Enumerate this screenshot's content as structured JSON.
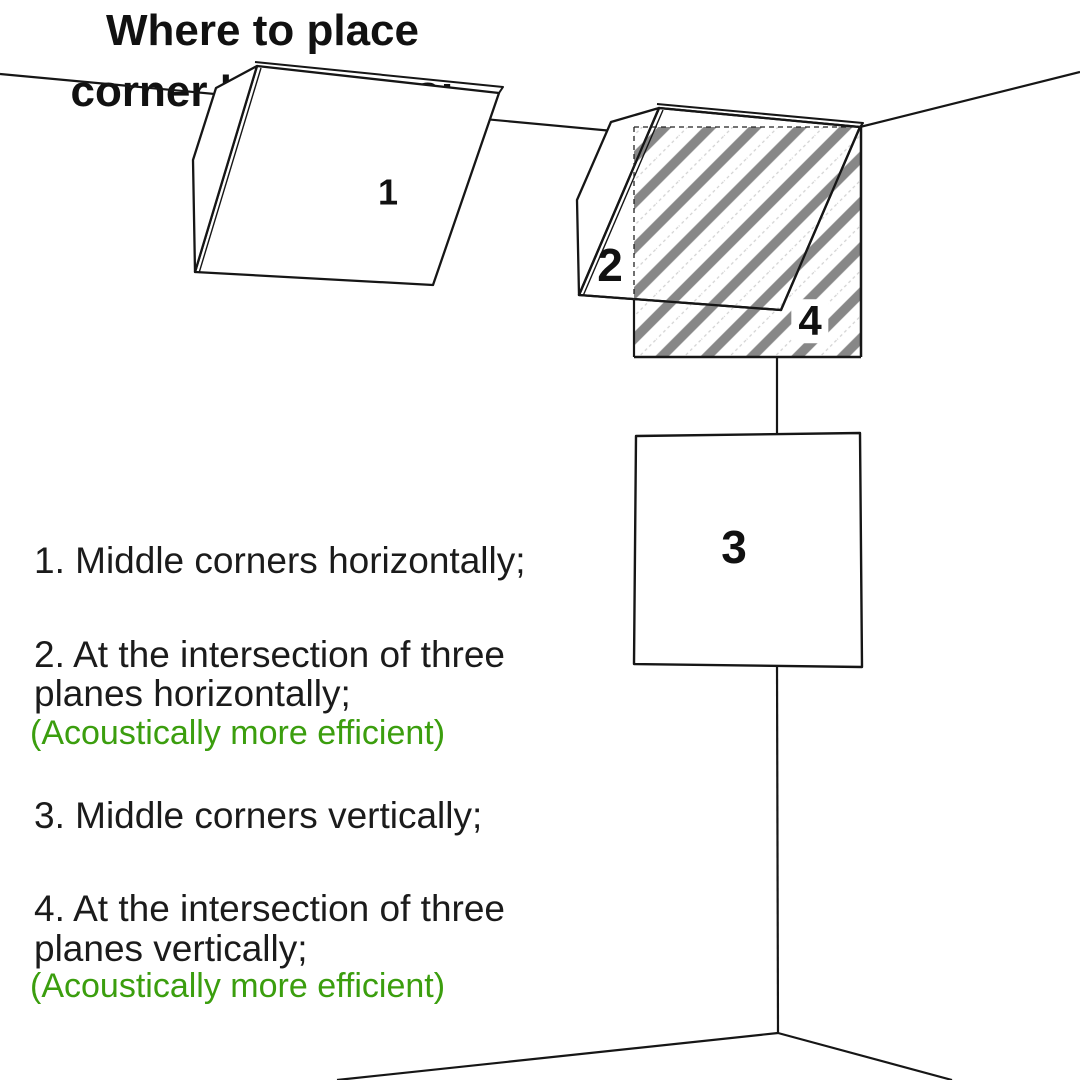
{
  "title": {
    "line1": "Where to place",
    "line2": "corner bass traps:"
  },
  "list": {
    "item1": {
      "line1": "1. Middle corners horizontally;"
    },
    "item2": {
      "line1": "2. At the intersection of three",
      "line2": "planes horizontally;",
      "note": "(Acoustically more efficient)"
    },
    "item3": {
      "line1": "3. Middle corners vertically;"
    },
    "item4": {
      "line1": "4. At the intersection of three",
      "line2": "planes vertically;",
      "note": "(Acoustically more efficient)"
    }
  },
  "diagram": {
    "labels": {
      "trap1": "1",
      "trap2": "2",
      "trap3": "3",
      "trap4": "4"
    }
  },
  "colors": {
    "accent_green": "#3b9e0e",
    "stripe_gray": "#878787",
    "line_color": "#161616"
  }
}
